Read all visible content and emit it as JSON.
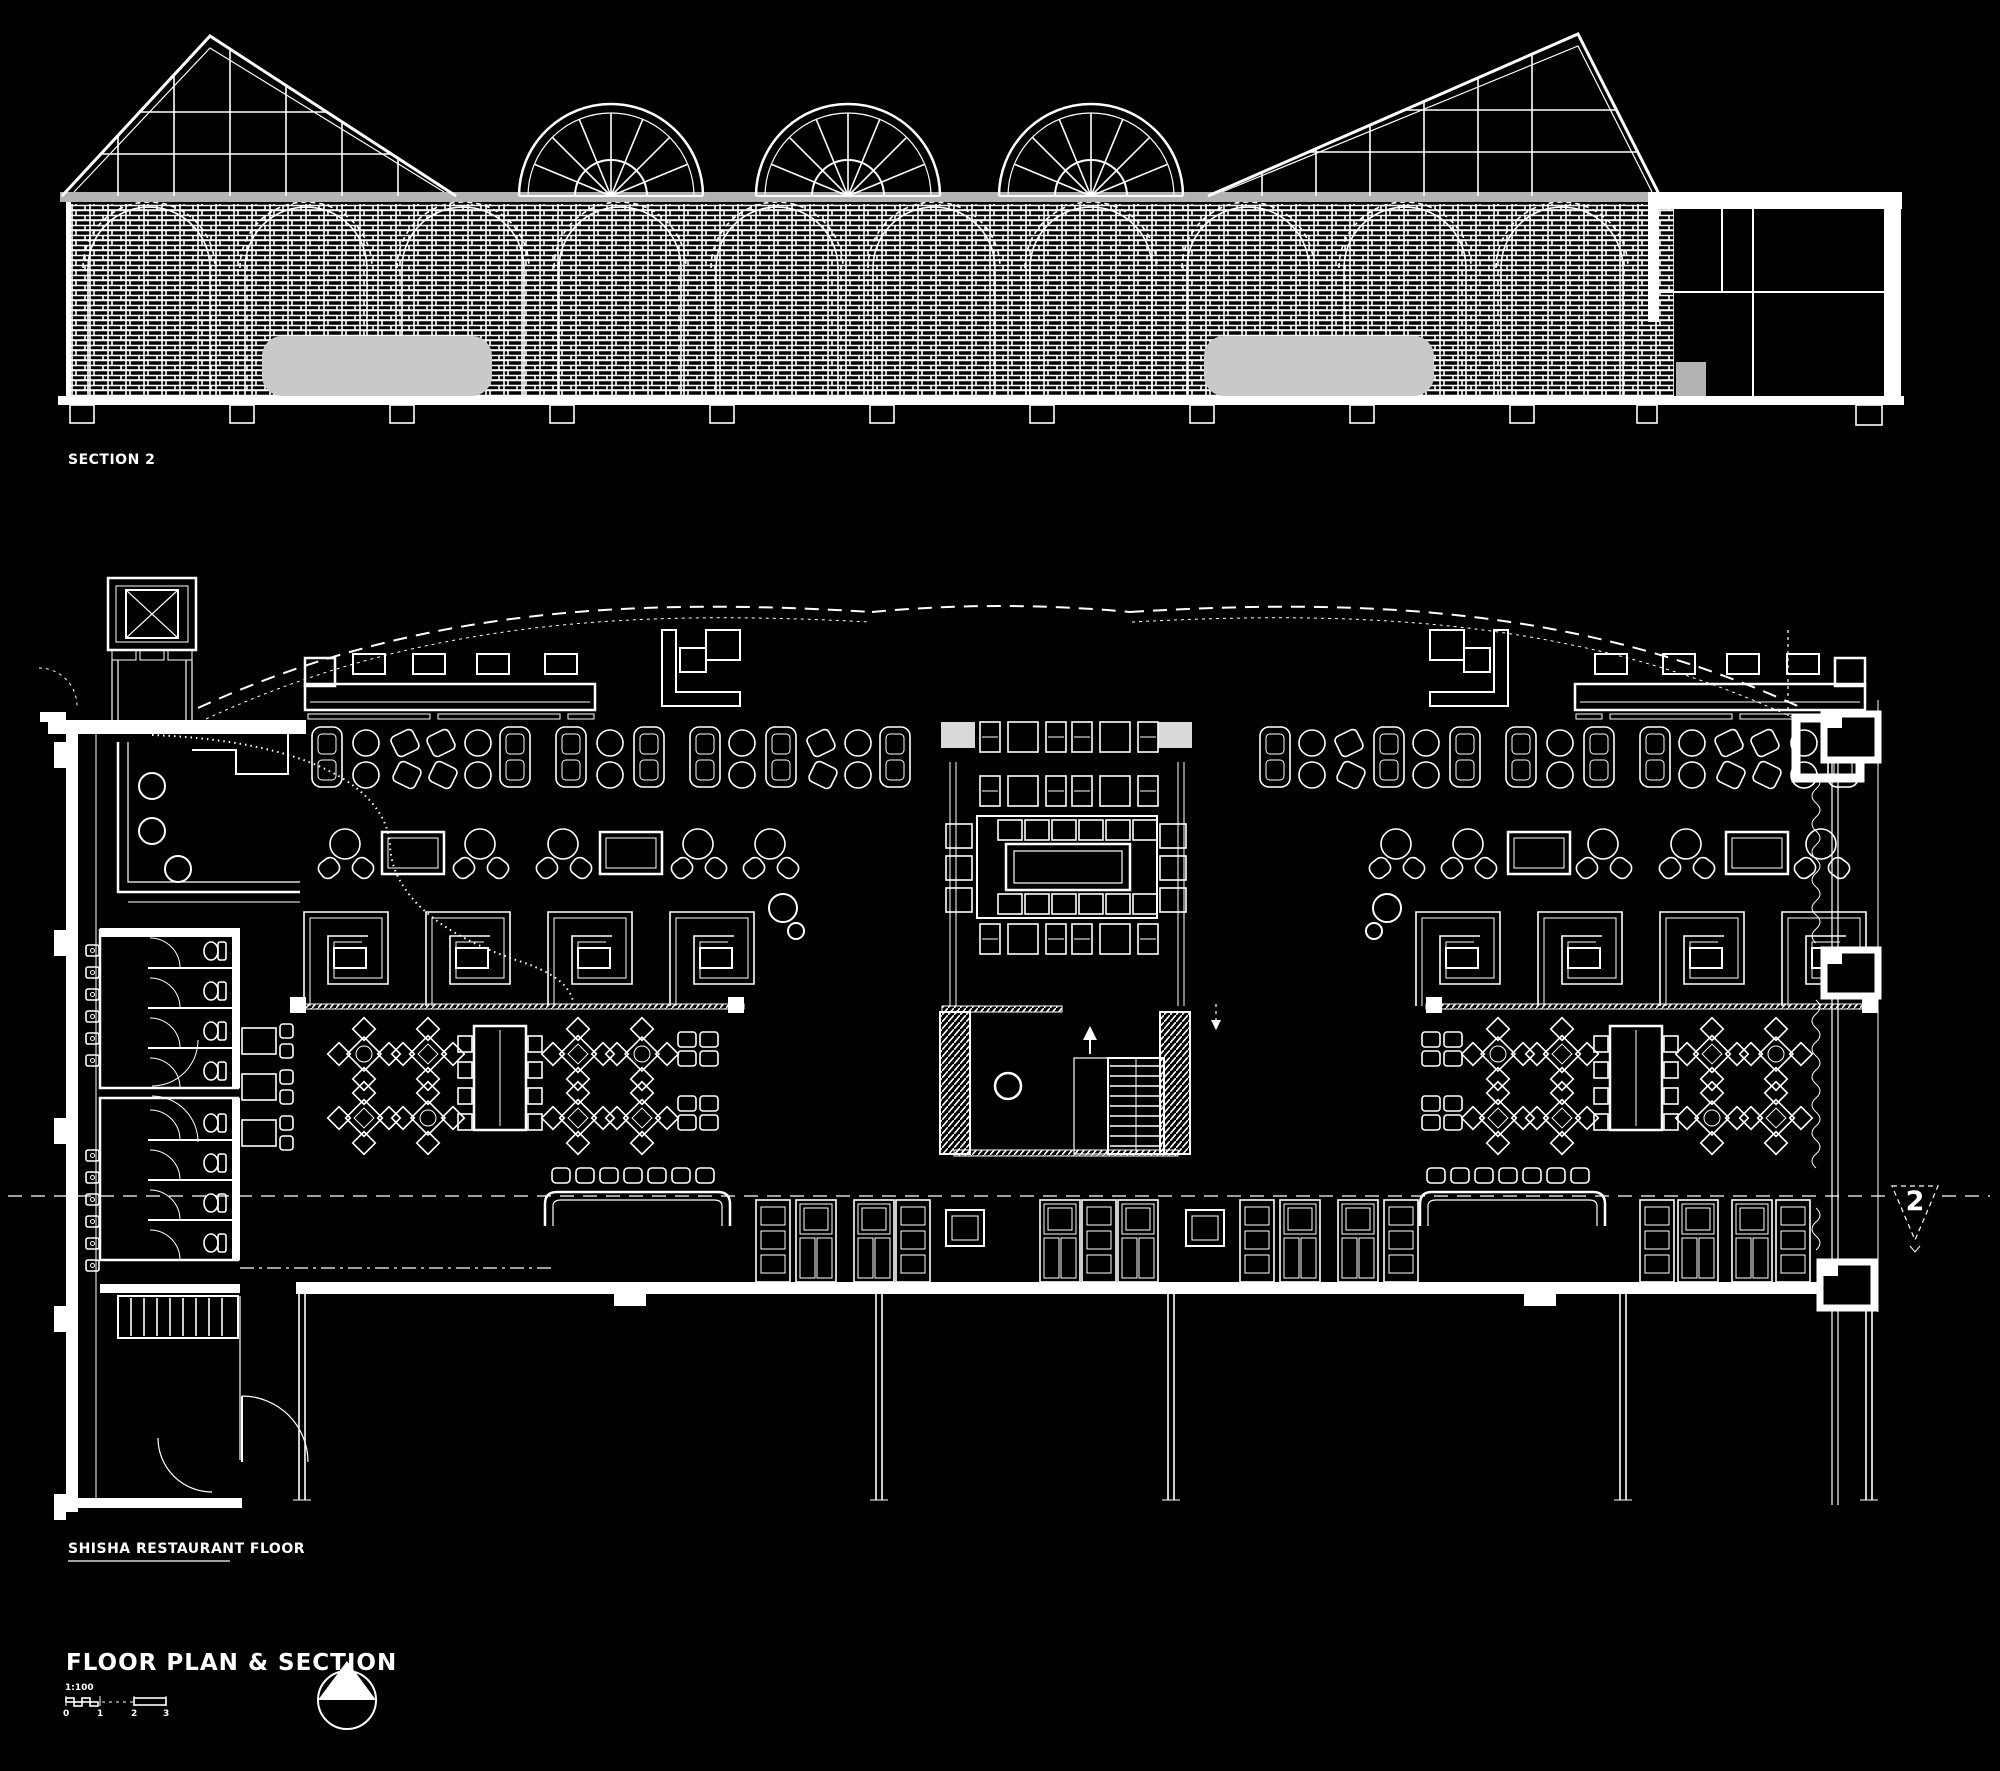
{
  "labels": {
    "section": "SECTION 2",
    "plan": "SHISHA RESTAURANT FLOOR"
  },
  "plan": {
    "section_marker": "2",
    "section_marker_icon": "section-cut-triangle-icon"
  },
  "titleblock": {
    "title": "FLOOR PLAN & SECTION",
    "scale_ratio": "1:100",
    "ticks": [
      "0",
      "1",
      "2",
      "3"
    ],
    "north_arrow_icon": "north-arrow-icon"
  },
  "colors": {
    "background": "#000000",
    "line": "#ffffff",
    "eaves_gray": "#b3b3b3",
    "banquette_gray": "#c9c9c9",
    "glazing_gray": "#4a4a4a"
  }
}
